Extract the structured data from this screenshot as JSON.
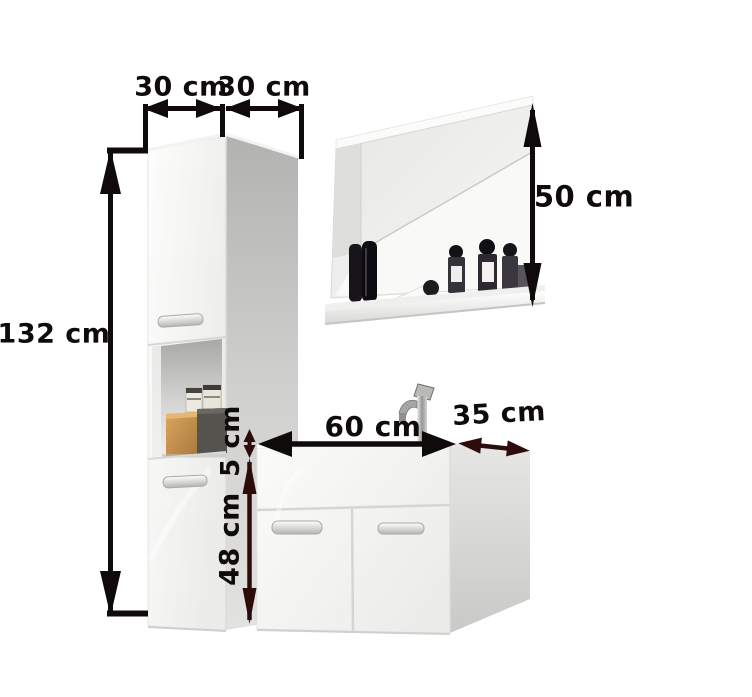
{
  "diagram": {
    "labels": {
      "tall_cabinet_width": "30 cm",
      "tall_cabinet_depth": "30 cm",
      "tall_cabinet_height": "132 cm",
      "mirror_height": "50 cm",
      "vanity_width": "60 cm",
      "vanity_depth": "35 cm",
      "countertop_height": "5 cm",
      "vanity_body_height": "48 cm"
    },
    "colors": {
      "background": "#ffffff",
      "dimension_black": "#0f0b0b",
      "dimension_maroon": "#2e0c0c",
      "furniture_white": "#f8f8f7",
      "panel_gray": "#c9c9c7",
      "wood_accent": "#c59455"
    }
  }
}
